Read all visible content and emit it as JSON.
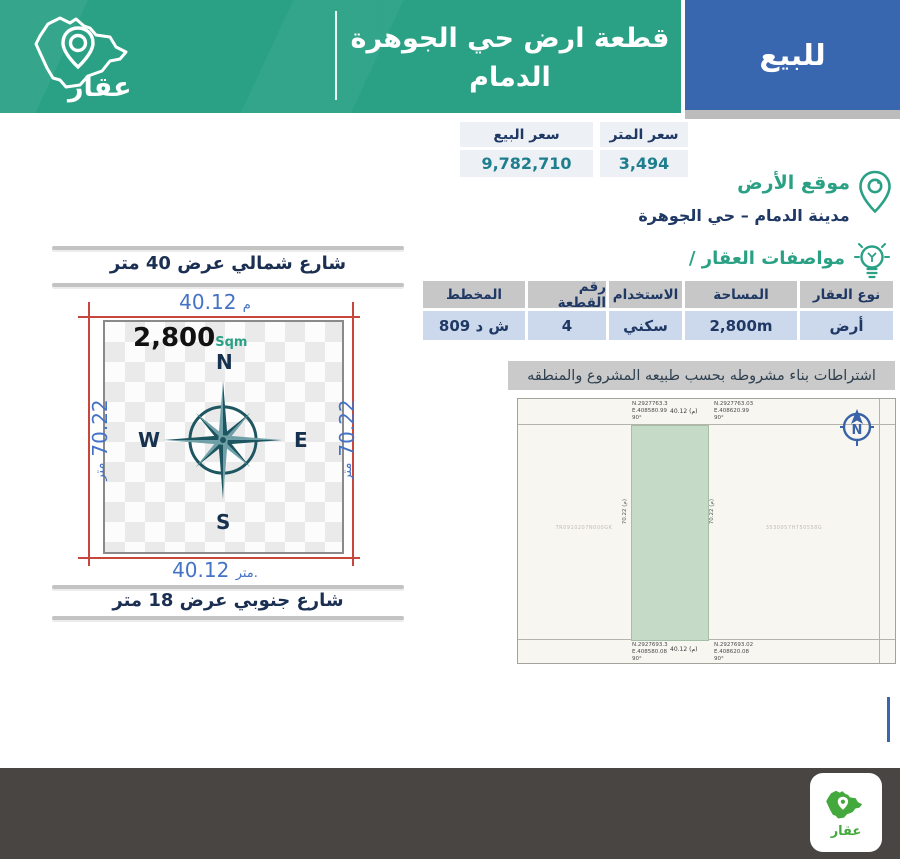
{
  "brand": {
    "logo_text": "عقار"
  },
  "header": {
    "title_line1": "قطعة ارض حي الجوهرة",
    "title_line2": "الدمام",
    "sale_badge": "للبيع"
  },
  "pricing": {
    "sale_price_label": "سعر البيع",
    "sale_price_value": "9,782,710",
    "meter_price_label": "سعر المتر",
    "meter_price_value": "3,494"
  },
  "location": {
    "heading": "موقع الأرض",
    "value": "مدينة الدمام – حي الجوهرة"
  },
  "specs": {
    "heading": "مواصفات العقار /",
    "columns": [
      "نوع العقار",
      "المساحة",
      "الاستخدام",
      "رقم القطعة",
      "المخطط"
    ],
    "values": [
      "أرض",
      "2,800m",
      "سكني",
      "4",
      "ش د 809"
    ],
    "note": "اشتراطات بناء مشروطه بحسب طبيعه المشروع والمنطقه"
  },
  "plot": {
    "north_street": "شارع شمالي عرض 40 متر",
    "south_street": "شارع جنوبي عرض 18 متر",
    "width_top_value": "40.12",
    "width_top_unit": "م",
    "width_bottom_value": "40.12",
    "width_bottom_unit": "متر.",
    "depth_left_value": "70.22",
    "depth_left_unit": "متر",
    "depth_right_value": "70.22",
    "depth_right_unit": "متر",
    "area_value": "2,800",
    "area_unit": "Sqm",
    "compass": {
      "north": "N",
      "east": "E",
      "south": "S",
      "west": "W"
    }
  },
  "survey": {
    "top_left_coord": "N.2927763.3\nE.408580.99\n90°",
    "top_right_coord": "N.2927763.03\nE.408620.99\n90°",
    "top_dim": "40.12 (م)",
    "bottom_left_coord": "N.2927693.3\nE.408580.08\n90°",
    "bottom_right_coord": "N.2927693.02\nE.408620.08\n90°",
    "bottom_dim": "40.12 (م)",
    "left_parcel_id": "TR0910207N000GK",
    "right_parcel_id": "3530057H750558G",
    "left_dim": "70.22 (م)",
    "right_dim": "70.22 (م)",
    "compass_n": "N"
  },
  "colors": {
    "brand_green": "#2aa185",
    "badge_blue": "#3867b0",
    "navy_text": "#1f3864",
    "price_teal": "#1f7e8d",
    "dim_blue": "#4472c4",
    "dim_red": "#c8473d",
    "logo_green": "#44a93d",
    "plan_parcel_green": "#c5dbc7",
    "footer_gray": "#484543"
  }
}
